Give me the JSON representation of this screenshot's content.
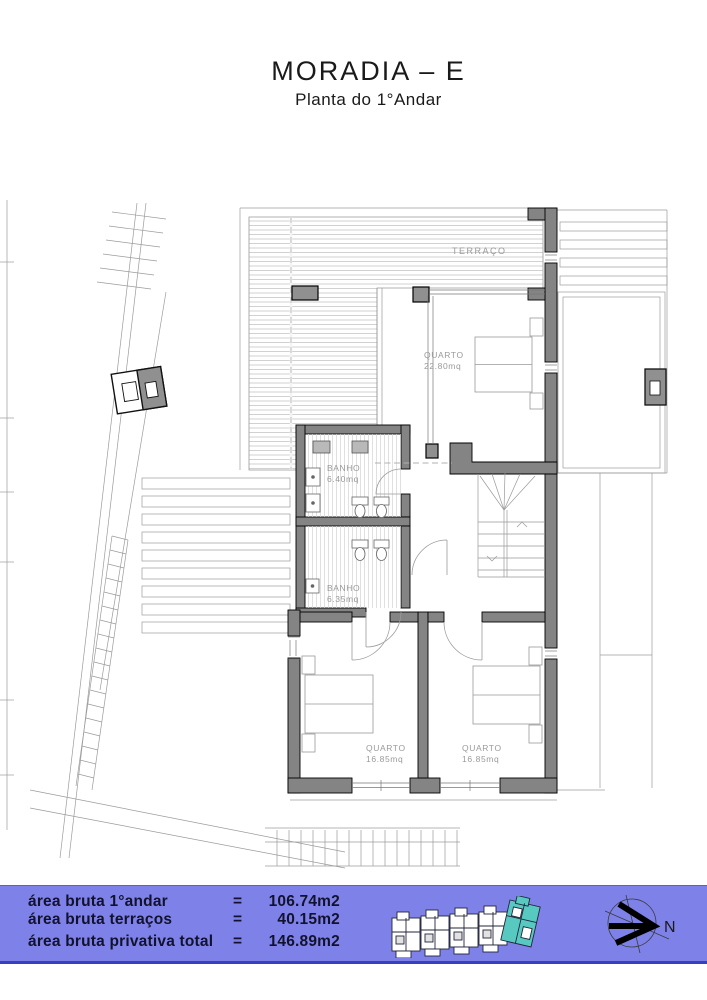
{
  "title": "MORADIA – E",
  "subtitle": "Planta do 1°Andar",
  "plan": {
    "terrace_label": "TERRAÇO",
    "rooms": [
      {
        "name": "QUARTO",
        "area": "22.80mq"
      },
      {
        "name": "BANHO",
        "area": "6.40mq"
      },
      {
        "name": "BANHO",
        "area": "6.35mq"
      },
      {
        "name": "QUARTO",
        "area": "16.85mq"
      },
      {
        "name": "QUARTO",
        "area": "16.85mq"
      }
    ]
  },
  "legend": {
    "rows": [
      {
        "label": "área bruta 1°andar",
        "eq": "=",
        "value": "106.74m2"
      },
      {
        "label": "área bruta terraços",
        "eq": "=",
        "value": "40.15m2"
      },
      {
        "label": "área bruta privativa total",
        "eq": "=",
        "value": "146.89m2"
      }
    ]
  },
  "compass": {
    "north_label": "N"
  },
  "colors": {
    "banner_bg": "#7e82e8",
    "banner_border": "#3a3ec0",
    "banner_text": "#12122e",
    "wall_gray": "#848484",
    "pillar_gray": "#909090",
    "highlight_teal": "#57c9c1",
    "line_gray": "#999999",
    "label_gray": "#9a9a9a"
  }
}
